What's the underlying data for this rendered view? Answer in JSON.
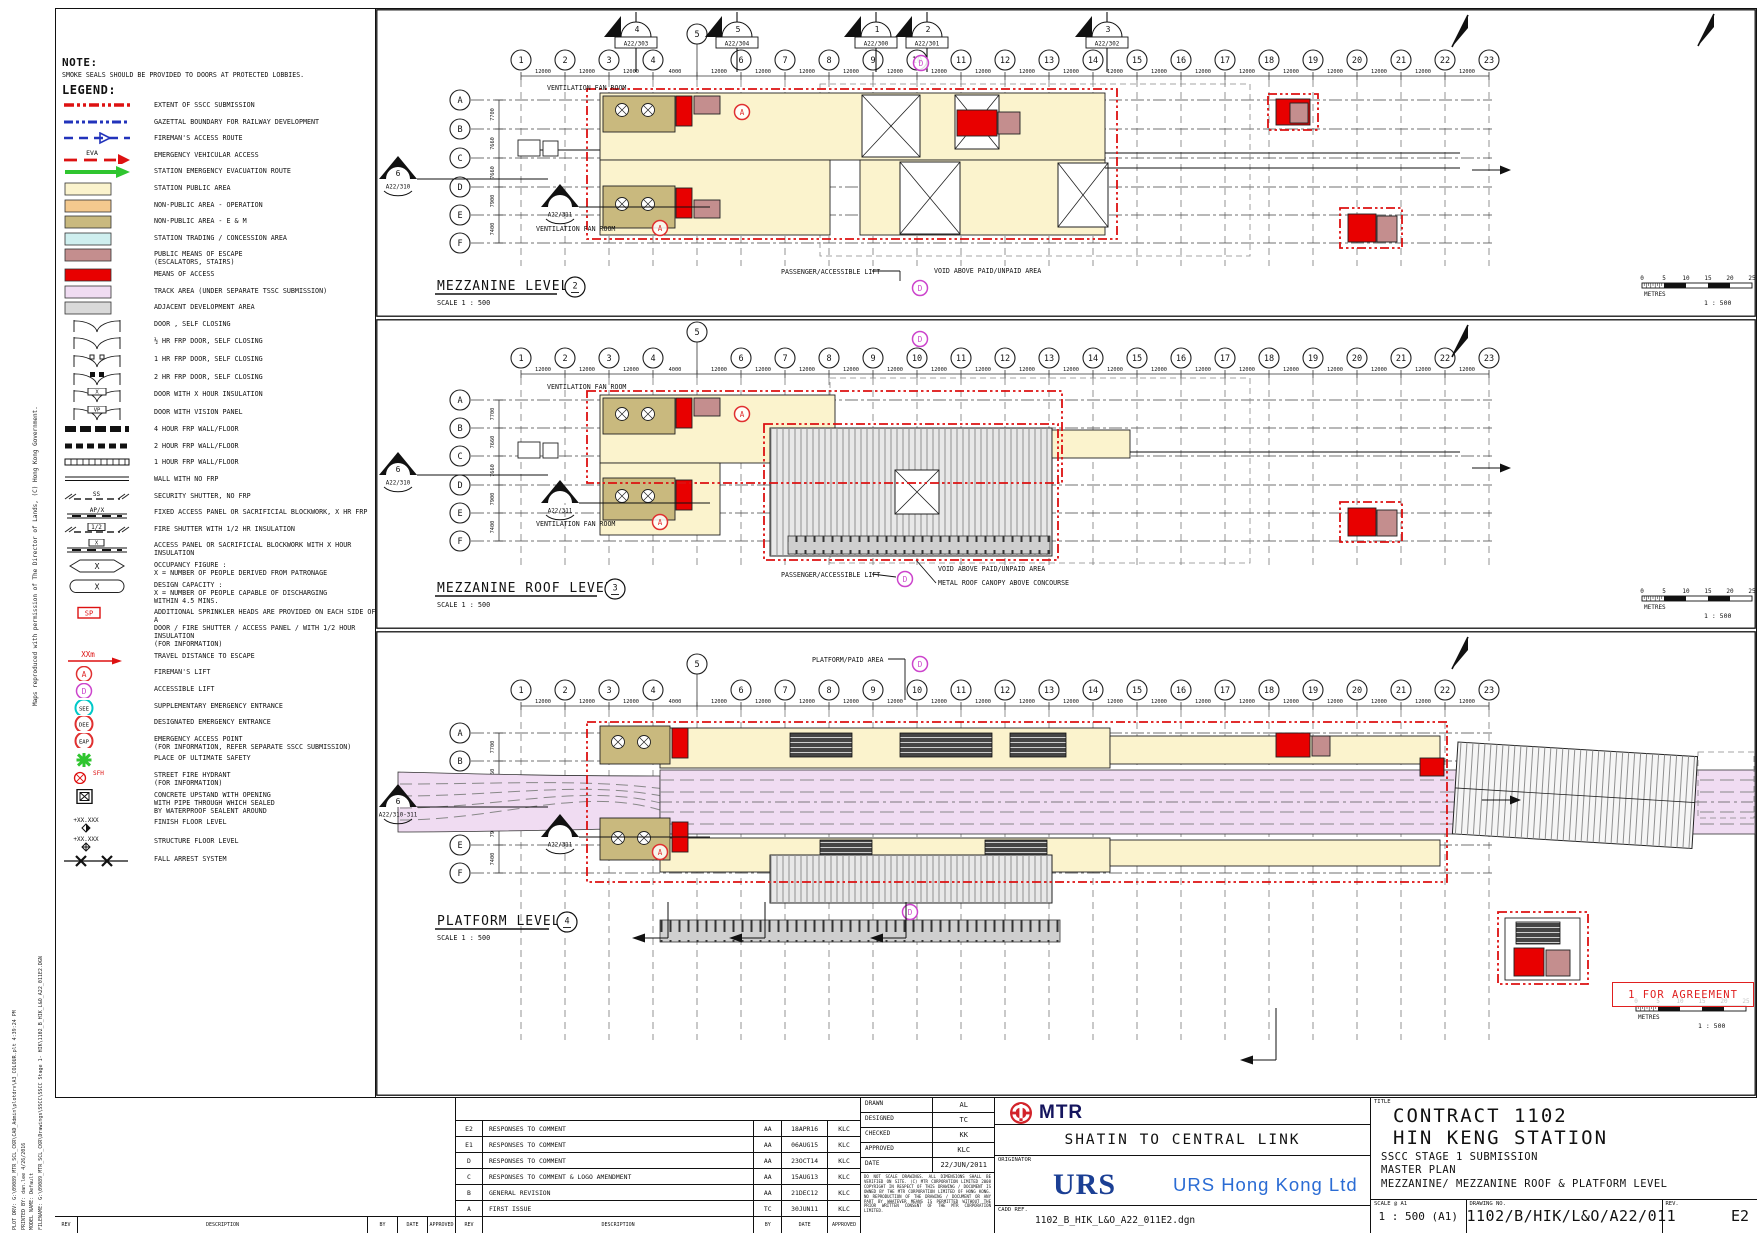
{
  "colors": {
    "public": "#FBF3CD",
    "operation": "#F4C98E",
    "em": "#C9B97E",
    "trading": "#CFEFEF",
    "escape": "#C48E8E",
    "access": "#E80000",
    "track": "#F0DCF2",
    "adjacent": "#D9D9D9",
    "sscc_red": "#DD1111",
    "gazettal_blue": "#2233BB",
    "eva_red": "#DD1111",
    "evac_green": "#2FC52F",
    "fireman_red": "#E03030",
    "accessible_magenta": "#CC44CC",
    "see_cyan": "#00C8C8",
    "mtr_red": "#D2232A",
    "urs_blue": "#1B3F94",
    "stamp_red": "#E02020"
  },
  "sheet": {
    "note_title": "NOTE:",
    "note_body": "SMOKE SEALS SHOULD BE PROVIDED TO DOORS AT PROTECTED LOBBIES.",
    "legend_title": "LEGEND:",
    "stamp": "1 FOR AGREEMENT",
    "side_top": "Maps reproduced with permission of The Director of Lands, (C) Hong Kong Government.",
    "side_bottom": [
      "PLOT DRV: G:\\09089_MTR_SCL_CKR\\CAD_Admin\\plotdrv\\A3_COLOUR.plt    4:39:24 PM",
      "PRINTED BY: dan.lee   4/26/2016",
      "MODEL NAME: Default",
      "FILENAME: G:\\09089_MTR_SCL_CKR\\Drawings\\SSCC\\SSCC Stage 1- HIK\\1102_B_HIK_L&O_A22_011E2.DGN"
    ]
  },
  "legend_items": [
    {
      "s": "line-sscc",
      "t": "EXTENT OF SSCC SUBMISSION"
    },
    {
      "s": "line-gaz",
      "t": "GAZETTAL BOUNDARY FOR RAILWAY DEVELOPMENT"
    },
    {
      "s": "line-fire",
      "t": "FIREMAN'S ACCESS ROUTE"
    },
    {
      "s": "line-eva",
      "tag": "EVA",
      "t": "EMERGENCY VEHICULAR ACCESS"
    },
    {
      "s": "arrow-green",
      "t": "STATION EMERGENCY EVACUATION ROUTE"
    },
    {
      "s": "sw-public",
      "t": "STATION PUBLIC AREA"
    },
    {
      "s": "sw-operation",
      "t": "NON-PUBLIC AREA - OPERATION"
    },
    {
      "s": "sw-em",
      "t": "NON-PUBLIC AREA - E & M"
    },
    {
      "s": "sw-trading",
      "t": "STATION TRADING / CONCESSION AREA"
    },
    {
      "s": "sw-escape",
      "t": "PUBLIC MEANS OF ESCAPE",
      "t2": "(ESCALATORS, STAIRS)"
    },
    {
      "s": "sw-access",
      "t": "MEANS OF ACCESS"
    },
    {
      "s": "sw-track",
      "t": "TRACK AREA (UNDER SEPARATE TSSC SUBMISSION)"
    },
    {
      "s": "sw-adjacent",
      "t": "ADJACENT DEVELOPMENT AREA"
    },
    {
      "s": "door",
      "t": "DOOR , SELF CLOSING"
    },
    {
      "s": "door",
      "t": "½ HR FRP DOOR, SELF CLOSING"
    },
    {
      "s": "door1",
      "t": "1 HR FRP DOOR, SELF CLOSING"
    },
    {
      "s": "door2",
      "t": "2 HR FRP DOOR, SELF CLOSING"
    },
    {
      "s": "doorx",
      "tag": "X",
      "t": "DOOR WITH X HOUR INSULATION"
    },
    {
      "s": "doorx",
      "tag": "VP",
      "t": "DOOR WITH VISION PANEL"
    },
    {
      "s": "wall4",
      "t": "4 HOUR FRP WALL/FLOOR"
    },
    {
      "s": "wall2",
      "t": "2 HOUR FRP WALL/FLOOR"
    },
    {
      "s": "wall1",
      "t": "1 HOUR FRP WALL/FLOOR"
    },
    {
      "s": "wall0",
      "t": "WALL WITH NO FRP"
    },
    {
      "s": "ss",
      "tag": "SS",
      "t": "SECURITY SHUTTER, NO FRP"
    },
    {
      "s": "apx",
      "tag": "AP/X",
      "t": "FIXED ACCESS PANEL OR SACRIFICIAL BLOCKWORK, X HR FRP"
    },
    {
      "s": "fs",
      "tag": "1/2",
      "t": "FIRE SHUTTER WITH 1/2 HR INSULATION"
    },
    {
      "s": "apxi",
      "tag": "X",
      "t": "ACCESS PANEL OR SACRIFICIAL BLOCKWORK WITH X HOUR INSULATION"
    },
    {
      "s": "hex",
      "sym": "X",
      "t": "OCCUPANCY FIGURE :",
      "t2": "X = NUMBER OF PEOPLE DERIVED FROM PATRONAGE"
    },
    {
      "s": "oval",
      "sym": "X",
      "t": "DESIGN CAPACITY :",
      "t2": "X = NUMBER OF PEOPLE CAPABLE OF DISCHARGING",
      "t3": "   WITHIN 4.5 MINS."
    },
    {
      "s": "sp",
      "sym": "SP",
      "t": "ADDITIONAL SPRINKLER HEADS ARE PROVIDED ON EACH SIDE OF A",
      "t2": "DOOR / FIRE SHUTTER / ACCESS PANEL / WITH 1/2 HOUR INSULATION",
      "t3": "(FOR INFORMATION)"
    },
    {
      "s": "xxm",
      "tag": "XXm",
      "t": "TRAVEL DISTANCE TO ESCAPE"
    },
    {
      "s": "cA",
      "sym": "A",
      "t": "FIREMAN'S LIFT"
    },
    {
      "s": "cD",
      "sym": "D",
      "t": "ACCESSIBLE LIFT"
    },
    {
      "s": "cSEE",
      "sym": "SEE",
      "t": "SUPPLEMENTARY EMERGENCY ENTRANCE"
    },
    {
      "s": "cDEE",
      "sym": "DEE",
      "t": "DESIGNATED EMERGENCY ENTRANCE"
    },
    {
      "s": "cEAP",
      "sym": "EAP",
      "t": "EMERGENCY ACCESS POINT",
      "t2": "(FOR INFORMATION, REFER SEPARATE SSCC SUBMISSION)"
    },
    {
      "s": "star",
      "t": "PLACE OF ULTIMATE SAFETY"
    },
    {
      "s": "sfh",
      "tag": "SFH",
      "t": "STREET FIRE HYDRANT",
      "t2": "(FOR INFORMATION)"
    },
    {
      "s": "upstand",
      "t": "CONCRETE UPSTAND WITH OPENING",
      "t2": "WITH PIPE THROUGH WHICH SEALED",
      "t3": "BY WATERPROOF SEALENT AROUND"
    },
    {
      "s": "ffl",
      "tag": "+XX.XXX",
      "t": "FINISH FLOOR LEVEL"
    },
    {
      "s": "sfl",
      "tag": "+XX.XXX",
      "t": "STRUCTURE FLOOR LEVEL"
    },
    {
      "s": "fall",
      "t": "FALL ARREST SYSTEM"
    }
  ],
  "grid": {
    "columns": [
      "1",
      "2",
      "3",
      "4",
      "5",
      "6",
      "7",
      "8",
      "9",
      "10",
      "11",
      "12",
      "13",
      "14",
      "15",
      "16",
      "17",
      "18",
      "19",
      "20",
      "21",
      "22",
      "23"
    ],
    "spacings": [
      "12000",
      "12000",
      "12000",
      "4000",
      "12000",
      "12000",
      "12000",
      "12000",
      "12000",
      "12000",
      "12000",
      "12000",
      "12000",
      "12000",
      "12000",
      "12000",
      "12000",
      "12000",
      "12000",
      "12000",
      "12000",
      "12000"
    ],
    "rows": [
      "A",
      "B",
      "C",
      "D",
      "E",
      "F"
    ],
    "row_dims": [
      "7700",
      "7660",
      "7660",
      "7900",
      "7400"
    ]
  },
  "scalebar": {
    "ticks": [
      "0",
      "5",
      "10",
      "15",
      "20",
      "25"
    ],
    "unit": "METRES",
    "ratio": "1 : 500"
  },
  "plans": [
    {
      "name": "mezzanine-level",
      "title": "MEZZANINE LEVEL",
      "bubble": "2",
      "scale_note": "SCALE 1 : 500",
      "annotations": [
        {
          "t": "VENTILATION FAN ROOM",
          "x": 547,
          "y": 90
        },
        {
          "t": "VENTILATION FAN ROOM",
          "x": 536,
          "y": 231
        },
        {
          "t": "PASSENGER/ACCESSIBLE LIFT",
          "x": 781,
          "y": 274
        },
        {
          "t": "VOID ABOVE PAID/UNPAID AREA",
          "x": 934,
          "y": 273
        }
      ],
      "markers_top": [
        {
          "n": "4",
          "ref": "A22/303",
          "x": 636
        },
        {
          "n": "5",
          "ref": "A22/304",
          "x": 737
        },
        {
          "n": "1",
          "ref": "A22/300",
          "x": 876
        },
        {
          "n": "2",
          "ref": "A22/301",
          "x": 927
        },
        {
          "n": "3",
          "ref": "A22/302",
          "x": 1107
        }
      ],
      "markers_left": [
        {
          "n": "6",
          "ref": "A22/310",
          "x": 398,
          "y": 168
        },
        {
          "n": "",
          "ref": "A22/311",
          "x": 560,
          "y": 196
        }
      ],
      "lift_a": [
        [
          742,
          112
        ],
        [
          660,
          228
        ]
      ],
      "lift_d": [
        [
          921,
          63
        ],
        [
          920,
          288
        ]
      ]
    },
    {
      "name": "mezzanine-roof-level",
      "title": "MEZZANINE ROOF LEVEL",
      "bubble": "3",
      "scale_note": "SCALE 1 : 500",
      "annotations": [
        {
          "t": "VENTILATION FAN ROOM",
          "x": 547,
          "y": 389
        },
        {
          "t": "VENTILATION FAN ROOM",
          "x": 536,
          "y": 526
        },
        {
          "t": "PASSENGER/ACCESSIBLE LIFT",
          "x": 781,
          "y": 577
        },
        {
          "t": "VOID ABOVE PAID/UNPAID AREA",
          "x": 938,
          "y": 571
        },
        {
          "t": "METAL ROOF CANOPY ABOVE CONCOURSE",
          "x": 938,
          "y": 585
        }
      ],
      "markers_top": [],
      "markers_left": [
        {
          "n": "6",
          "ref": "A22/310",
          "x": 398,
          "y": 464
        },
        {
          "n": "",
          "ref": "A22/311",
          "x": 560,
          "y": 492
        }
      ],
      "lift_a": [
        [
          742,
          414
        ],
        [
          660,
          522
        ]
      ],
      "lift_d": [
        [
          920,
          339
        ],
        [
          905,
          579
        ]
      ]
    },
    {
      "name": "platform-level",
      "title": "PLATFORM LEVEL",
      "bubble": "4",
      "scale_note": "SCALE 1 : 500",
      "annotations": [
        {
          "t": "PLATFORM/PAID AREA",
          "x": 812,
          "y": 662
        }
      ],
      "markers_top": [],
      "markers_left": [
        {
          "n": "6",
          "ref": "A22/310-311",
          "x": 398,
          "y": 796
        },
        {
          "n": "",
          "ref": "A22/311",
          "x": 560,
          "y": 826
        }
      ],
      "lift_a": [
        [
          660,
          852
        ]
      ],
      "lift_d": [
        [
          920,
          664
        ],
        [
          910,
          912
        ]
      ]
    }
  ],
  "revisions": {
    "headers": [
      "REV",
      "DESCRIPTION",
      "BY",
      "DATE",
      "APPROVED"
    ],
    "rows": [
      [
        "E2",
        "RESPONSES TO COMMENT",
        "AA",
        "18APR16",
        "KLC"
      ],
      [
        "E1",
        "RESPONSES TO COMMENT",
        "AA",
        "06AUG15",
        "KLC"
      ],
      [
        "D",
        "RESPONSES TO COMMENT",
        "AA",
        "23OCT14",
        "KLC"
      ],
      [
        "C",
        "RESPONSES TO COMMENT & LOGO AMENDMENT",
        "AA",
        "15AUG13",
        "KLC"
      ],
      [
        "B",
        "GENERAL REVISION",
        "AA",
        "21DEC12",
        "KLC"
      ],
      [
        "A",
        "FIRST ISSUE",
        "TC",
        "30JUN11",
        "KLC"
      ]
    ]
  },
  "titleblock": {
    "title_label": "TITLE",
    "title_lines": [
      "CONTRACT 1102",
      "HIN KENG STATION",
      "SSCC STAGE 1 SUBMISSION",
      "MASTER PLAN",
      "MEZZANINE/ MEZZANINE ROOF & PLATFORM LEVEL"
    ],
    "scale_label": "SCALE @ A1",
    "scale_value": "1 : 500 (A1)",
    "drawing_no_label": "DRAWING NO.",
    "drawing_no": "1102/B/HIK/L&O/A22/011",
    "rev_label": "REV.",
    "rev_value": "E2",
    "approvals": [
      [
        "DRAWN",
        "AL"
      ],
      [
        "DESIGNED",
        "TC"
      ],
      [
        "CHECKED",
        "KK"
      ],
      [
        "APPROVED",
        "KLC"
      ],
      [
        "DATE",
        "22/JUN/2011"
      ]
    ],
    "copyright": "DO NOT SCALE DRAWINGS. ALL DIMENSIONS SHALL BE VERIFIED ON SITE. (C) MTR CORPORATION LIMITED 2008 COPYRIGHT IN RESPECT OF THIS DRAWING / DOCUMENT IS OWNED BY THE MTR CORPORATION LIMITED OF HONG KONG. NO REPRODUCTION OF THE DRAWING / DOCUMENT OR ANY PART BY WHATEVER MEANS IS PERMITTED WITHOUT THE PRIOR WRITTEN CONSENT OF THE MTR CORPORATION LIMITED.",
    "project": "SHATIN TO CENTRAL LINK",
    "originator_label": "ORIGINATOR",
    "originator_logo": "URS",
    "originator_name": "URS Hong Kong Ltd",
    "mtr_logo_text": "MTR",
    "cadd_label": "CADD REF.",
    "cadd_value": "1102_B_HIK_L&O_A22_011E2.dgn"
  }
}
